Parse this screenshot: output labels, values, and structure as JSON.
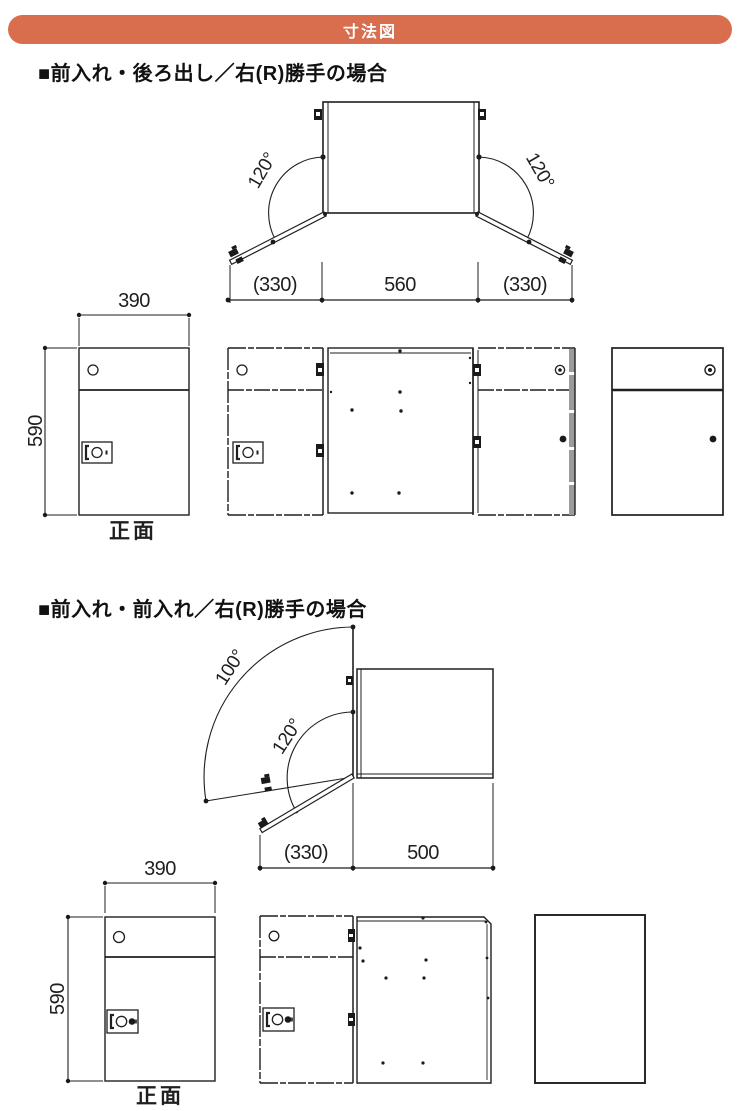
{
  "banner": {
    "title": "寸法図"
  },
  "colors": {
    "accent": "#d96e4e",
    "line": "#1f1f1f"
  },
  "sections": [
    {
      "heading": "■前入れ・後ろ出し／右(R)勝手の場合",
      "top_view": {
        "angle_left": "120°",
        "angle_right": "120°",
        "dim_left": "(330)",
        "dim_center": "560",
        "dim_right": "(330)"
      },
      "front_row": {
        "width": "390",
        "height": "590",
        "caption": "正面"
      }
    },
    {
      "heading": "■前入れ・前入れ／右(R)勝手の場合",
      "top_view": {
        "angle_outer": "100°",
        "angle_inner": "120°",
        "dim_left": "(330)",
        "dim_right": "500"
      },
      "front_row": {
        "width": "390",
        "height": "590",
        "caption": "正面"
      }
    }
  ]
}
